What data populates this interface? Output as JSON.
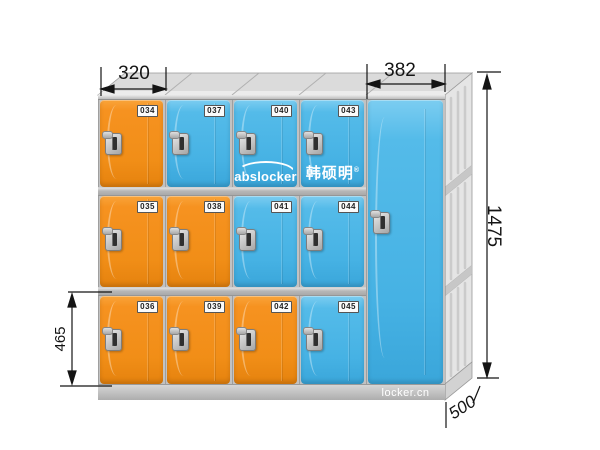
{
  "title": "ABS plastic locker dimension diagram",
  "background": "#ffffff",
  "branding": {
    "abslocker_logo": "abslocker",
    "chinese_logo": "韩硕明",
    "registered_mark": "®",
    "website": "locker.cn"
  },
  "annotations": {
    "width_small_column": "320",
    "width_wide_door": "382",
    "height_total": "1475",
    "height_single_door": "465",
    "depth": "500"
  },
  "colors": {
    "door_orange": "#F69220",
    "door_blue": "#4CB8E8",
    "frame_grey": "#C2C2C2",
    "side_panel_grey": "#E5E5E5",
    "dimension_line": "#141414",
    "number_plate_bg": "#FBFBFB"
  },
  "lockers": {
    "columns": [
      {
        "doors": [
          {
            "number": "034",
            "color": "orange"
          },
          {
            "number": "035",
            "color": "orange"
          },
          {
            "number": "036",
            "color": "orange"
          }
        ]
      },
      {
        "doors": [
          {
            "number": "037",
            "color": "blue"
          },
          {
            "number": "038",
            "color": "orange"
          },
          {
            "number": "039",
            "color": "orange"
          }
        ]
      },
      {
        "doors": [
          {
            "number": "040",
            "color": "blue",
            "logo": "abslocker"
          },
          {
            "number": "041",
            "color": "blue"
          },
          {
            "number": "042",
            "color": "orange"
          }
        ]
      },
      {
        "doors": [
          {
            "number": "043",
            "color": "blue",
            "logo": "chinese"
          },
          {
            "number": "044",
            "color": "blue"
          },
          {
            "number": "045",
            "color": "blue"
          }
        ]
      }
    ],
    "wide_door": {
      "color": "blue"
    }
  }
}
